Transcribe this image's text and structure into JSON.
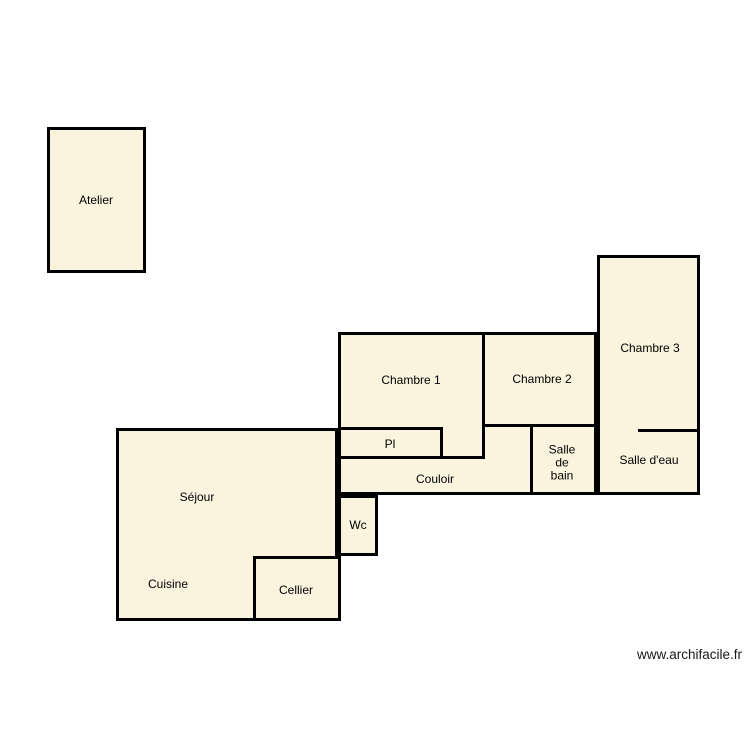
{
  "page": {
    "background": "#ffffff",
    "watermark": "www.archifacile.fr"
  },
  "palette": {
    "room_fill": "#FAF4DE",
    "wall_color": "#000000",
    "label_color": "#000000"
  },
  "labels": {
    "atelier": "Atelier",
    "chambre1": "Chambre 1",
    "chambre2": "Chambre 2",
    "chambre3": "Chambre 3",
    "pl": "Pl",
    "couloir": "Couloir",
    "salle_de_bain": "Salle\nde\nbain",
    "salle_deau": "Salle d'eau",
    "sejour": "Séjour",
    "cuisine": "Cuisine",
    "wc": "Wc",
    "cellier": "Cellier"
  }
}
